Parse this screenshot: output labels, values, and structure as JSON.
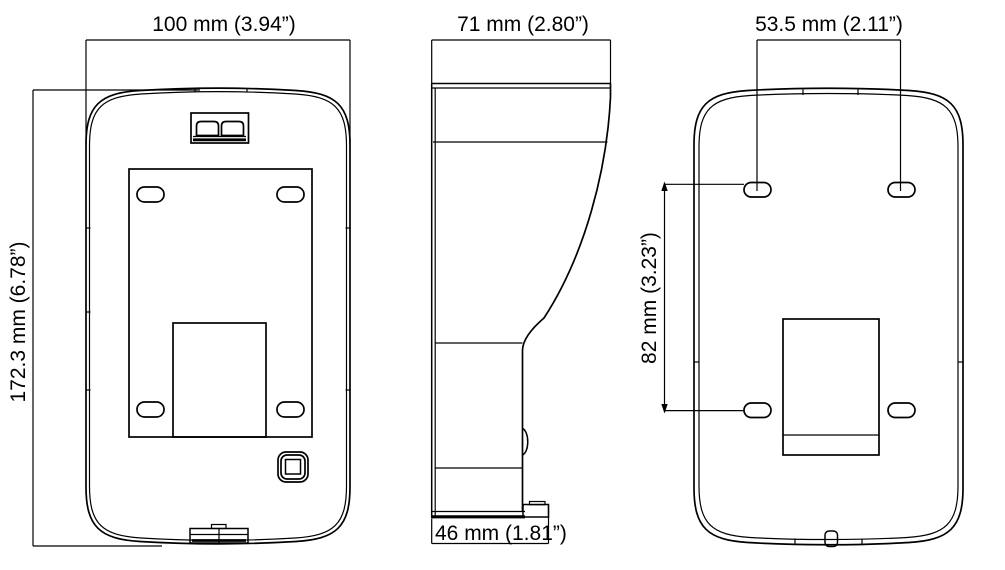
{
  "title": "Device dimensional drawing (front, side, back views)",
  "colors": {
    "line": "#000000",
    "background": "#ffffff"
  },
  "views": {
    "front": {
      "width_label": "100 mm (3.94”)",
      "height_label": "172.3 mm (6.78”)"
    },
    "side": {
      "top_width_label": "71 mm (2.80”)",
      "bottom_depth_label": "46 mm (1.81”)"
    },
    "back": {
      "hole_spacing_width_label": "53.5 mm (2.11”)",
      "hole_spacing_height_label": "82 mm (3.23”)"
    }
  }
}
